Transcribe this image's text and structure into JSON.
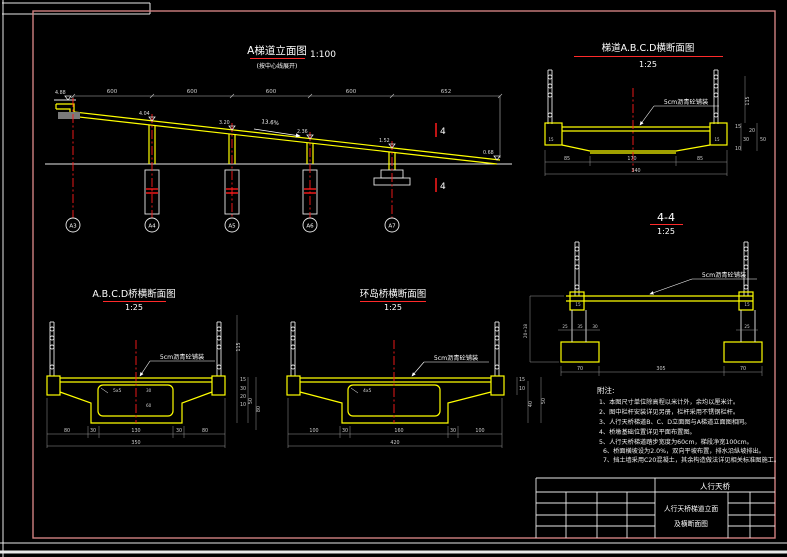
{
  "sheet": {
    "border_color": "#d08080",
    "accent_red": "#ff2a2a",
    "line_yellow": "#ffff00"
  },
  "elevation": {
    "title": "A梯道立面图",
    "scale": "1:100",
    "subtitle": "(按中心线展开)",
    "spans": [
      "600",
      "600",
      "600",
      "600",
      "652"
    ],
    "levels": [
      "4.88",
      "4.04",
      "3.20",
      "2.36",
      "1.52",
      "0.68"
    ],
    "slope": "13.6%",
    "axes": [
      "A3",
      "A4",
      "A5",
      "A6",
      "A7"
    ],
    "section_mark": "4"
  },
  "stair_section": {
    "title": "梯道A.B.C.D横断面图",
    "scale": "1:25",
    "pavement": "5cm沥青砼铺装",
    "block_dim": "15",
    "dims_bottom": [
      "85",
      "170",
      "85"
    ],
    "total": "340",
    "dims_right": [
      "115",
      "15",
      "20",
      "30",
      "10",
      "50"
    ]
  },
  "section44": {
    "title": "4-4",
    "scale": "1:25",
    "pavement": "5cm沥青砼铺装",
    "dim_left": "20+18",
    "block_dim": "15",
    "dims_col": [
      "25",
      "35",
      "30"
    ],
    "dim_col_right": "25",
    "dims_bottom": [
      "70",
      "305",
      "70"
    ]
  },
  "bridge_section": {
    "title": "A.B.C.D桥横断面图",
    "scale": "1:25",
    "pavement": "5cm沥青砼铺装",
    "chamfer": "5x5",
    "inner_dims": [
      "30",
      "60"
    ],
    "dims_bottom": [
      "80",
      "30",
      "130",
      "30",
      "80"
    ],
    "total": "350",
    "dims_right": [
      "115",
      "15",
      "30",
      "20",
      "10",
      "50",
      "80"
    ]
  },
  "island_section": {
    "title": "环岛桥横断面图",
    "scale": "1:25",
    "pavement": "5cm沥青砼铺装",
    "chamfer": "4x5",
    "dims_bottom": [
      "100",
      "30",
      "160",
      "30",
      "100"
    ],
    "total": "420",
    "dims_right": [
      "15",
      "10",
      "40",
      "50"
    ]
  },
  "notes": {
    "heading": "附注:",
    "items": [
      "1、本图尺寸单位除高程以米计外，余均以厘米计。",
      "2、图中栏杆安装详见另册，栏杆采用不锈钢栏杆。",
      "3、人行天桥梯道B、C、D立面图与A梯道立面图相同。",
      "4、桥墩基础位置详见平面布置图。",
      "5、人行天桥梯道踏步宽度为60cm，梯段净宽100cm。",
      "6、桥面横坡设为2.0%，双向平坡布置，排水沿纵坡排出。",
      "7、挡土墙采用C20混凝土，其余构造做法详见相关标准图施工。"
    ]
  },
  "title_block": {
    "project": "人行天桥",
    "title_line1": "人行天桥梯道立面",
    "title_line2": "及横断面图"
  }
}
